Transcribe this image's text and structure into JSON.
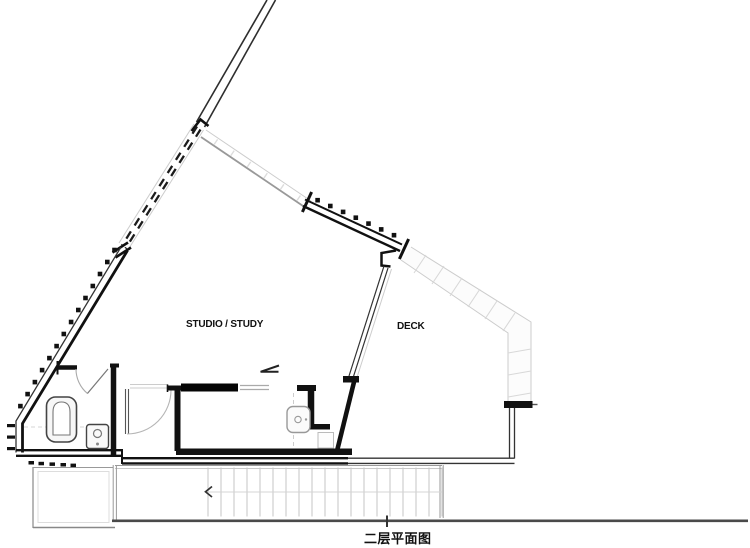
{
  "drawing": {
    "rooms": {
      "studio": "STUDIO / STUDY",
      "deck": "DECK"
    },
    "title_caption": "二层平面图",
    "colors": {
      "ink": "#1a1a1a",
      "wall_fill": "#111111",
      "mid_line": "#999999",
      "light_line": "#c9c9c9",
      "paper": "#ffffff"
    }
  }
}
